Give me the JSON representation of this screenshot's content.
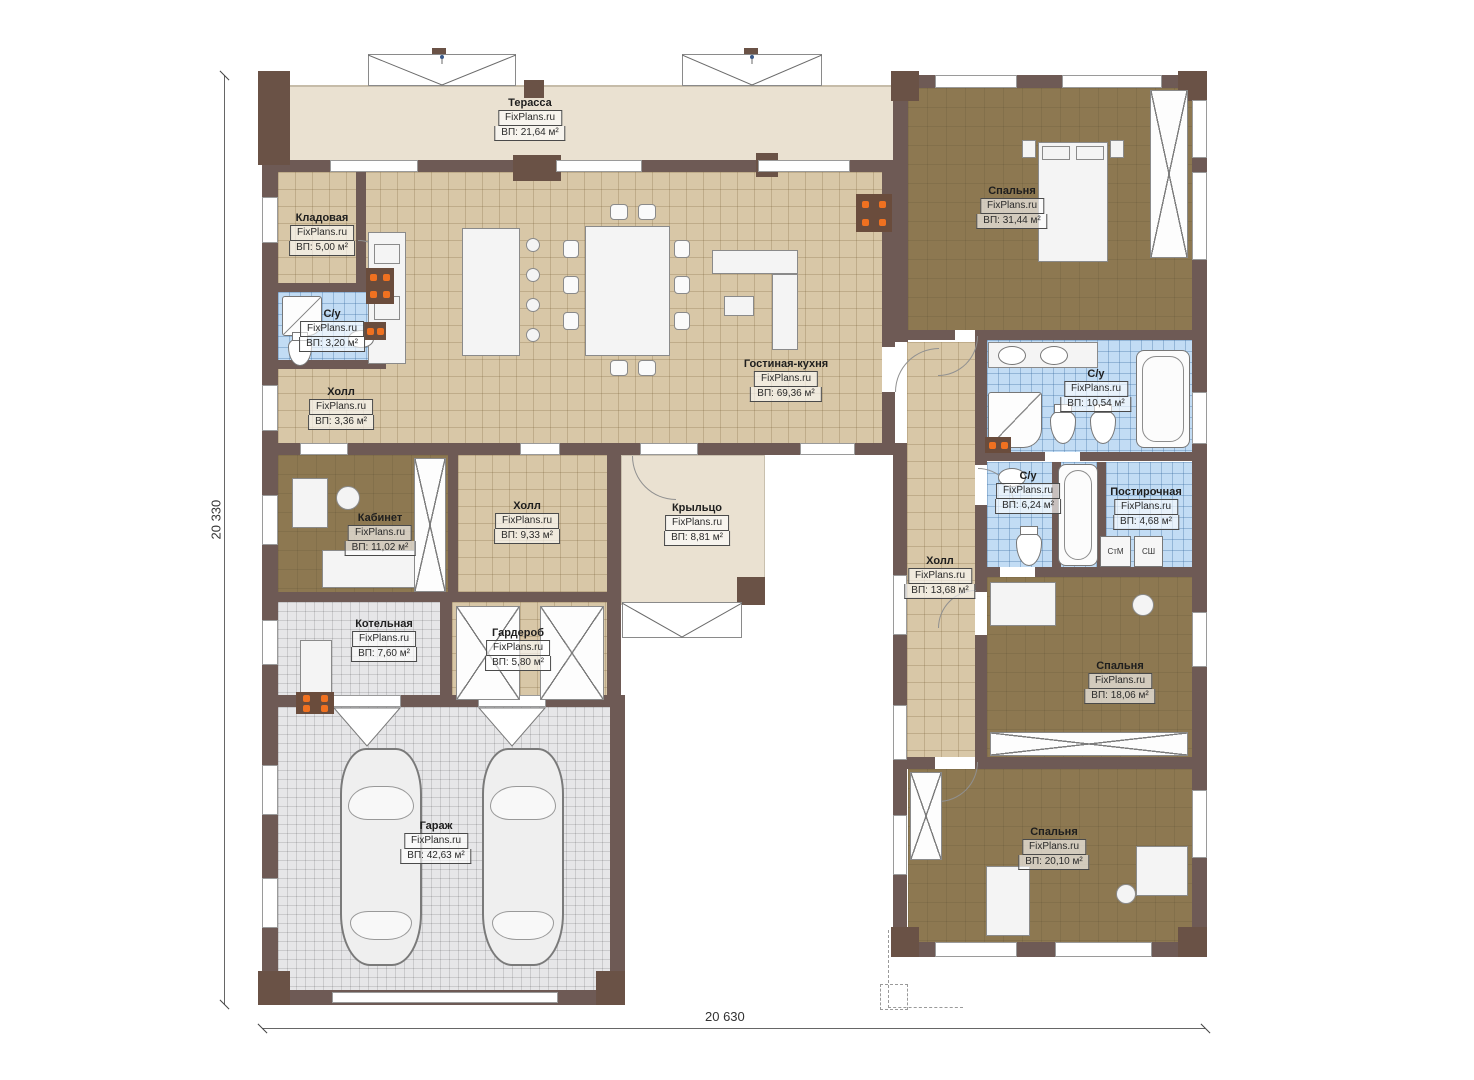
{
  "plan": {
    "source_watermark": "FixPlans.ru"
  },
  "dimensions": {
    "bottom": "20 630",
    "left": "20 330"
  },
  "appliances": {
    "washer": "СтМ",
    "dryer": "СШ"
  },
  "rooms": [
    {
      "key": "terrace",
      "name": "Терасса",
      "watermark": "FixPlans.ru",
      "area": "ВП: 21,64 м²"
    },
    {
      "key": "storage",
      "name": "Кладовая",
      "watermark": "FixPlans.ru",
      "area": "ВП: 5,00 м²"
    },
    {
      "key": "bath-small",
      "name": "С/у",
      "watermark": "FixPlans.ru",
      "area": "ВП: 3,20 м²"
    },
    {
      "key": "hall-small",
      "name": "Холл",
      "watermark": "FixPlans.ru",
      "area": "ВП: 3,36 м²"
    },
    {
      "key": "living-kitchen",
      "name": "Гостиная-кухня",
      "watermark": "FixPlans.ru",
      "area": "ВП: 69,36 м²"
    },
    {
      "key": "bedroom-master",
      "name": "Спальня",
      "watermark": "FixPlans.ru",
      "area": "ВП: 31,44 м²"
    },
    {
      "key": "bath-master",
      "name": "С/у",
      "watermark": "FixPlans.ru",
      "area": "ВП: 10,54 м²"
    },
    {
      "key": "office",
      "name": "Кабинет",
      "watermark": "FixPlans.ru",
      "area": "ВП: 11,02 м²"
    },
    {
      "key": "hall-mid",
      "name": "Холл",
      "watermark": "FixPlans.ru",
      "area": "ВП: 9,33 м²"
    },
    {
      "key": "porch",
      "name": "Крыльцо",
      "watermark": "FixPlans.ru",
      "area": "ВП: 8,81 м²"
    },
    {
      "key": "bath-guest",
      "name": "С/у",
      "watermark": "FixPlans.ru",
      "area": "ВП: 6,24 м²"
    },
    {
      "key": "laundry",
      "name": "Постирочная",
      "watermark": "FixPlans.ru",
      "area": "ВП: 4,68 м²"
    },
    {
      "key": "hall-main",
      "name": "Холл",
      "watermark": "FixPlans.ru",
      "area": "ВП: 13,68 м²"
    },
    {
      "key": "boiler",
      "name": "Котельная",
      "watermark": "FixPlans.ru",
      "area": "ВП: 7,60 м²"
    },
    {
      "key": "wardrobe",
      "name": "Гардероб",
      "watermark": "FixPlans.ru",
      "area": "ВП: 5,80 м²"
    },
    {
      "key": "bedroom-2",
      "name": "Спальня",
      "watermark": "FixPlans.ru",
      "area": "ВП: 18,06 м²"
    },
    {
      "key": "garage",
      "name": "Гараж",
      "watermark": "FixPlans.ru",
      "area": "ВП: 42,63 м²"
    },
    {
      "key": "bedroom-3",
      "name": "Спальня",
      "watermark": "FixPlans.ru",
      "area": "ВП: 20,10 м²"
    }
  ],
  "colors": {
    "wall": "#6e5a55",
    "pier": "#6a5246",
    "floor_tan": "#d8c7a7",
    "floor_brown": "#8d7851",
    "floor_blue": "#c2dcf4",
    "floor_gray": "#e6e6e8",
    "floor_beige": "#eae1d1",
    "radiator": "#f07120"
  }
}
